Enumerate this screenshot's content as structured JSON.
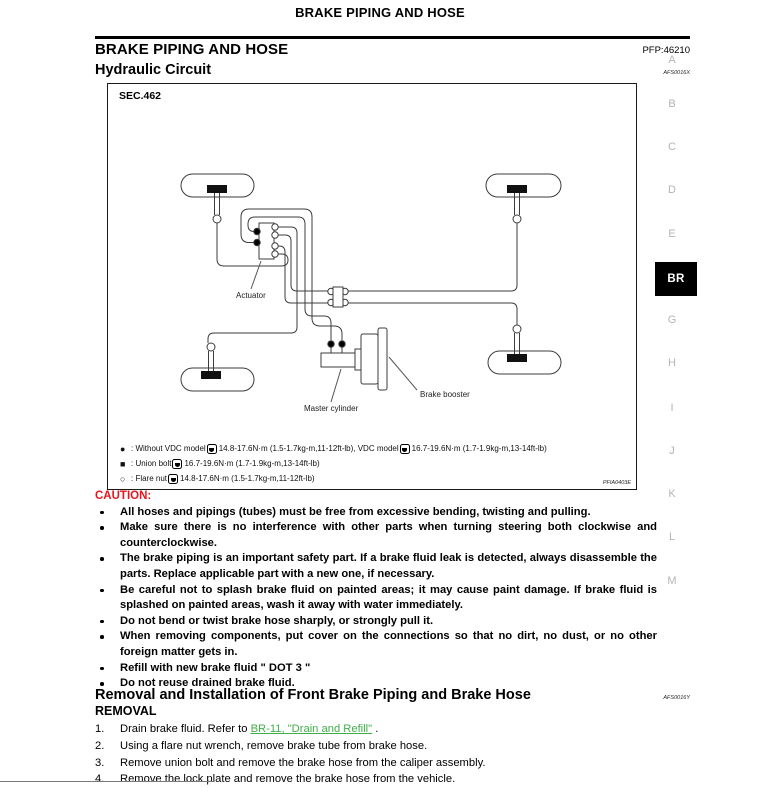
{
  "colors": {
    "caution_red": "#e8151d",
    "link_green": "#3fae49",
    "tab_gray": "#b4b4b4",
    "tab_active_bg": "#000000"
  },
  "header": {
    "page_title": "BRAKE PIPING AND HOSE"
  },
  "section": {
    "title": "BRAKE PIPING AND HOSE",
    "pfp": "PFP:46210"
  },
  "hydraulic": {
    "title": "Hydraulic Circuit",
    "ref": "AFS0016X"
  },
  "figure": {
    "sec": "SEC.462",
    "id": "PFIA0403E",
    "labels": {
      "actuator": "Actuator",
      "master_cylinder": "Master cylinder",
      "brake_booster": "Brake booster"
    },
    "legend": [
      {
        "symbol": "●",
        "parts": [
          ": Without VDC model ",
          "14.8-17.6N·m (1.5-1.7kg-m,11-12ft-lb), VDC model ",
          " 16.7-19.6N·m (1.7-1.9kg-m,13-14ft-lb)"
        ]
      },
      {
        "symbol": "■",
        "parts": [
          ": Union bolt ",
          "16.7-19.6N·m (1.7-1.9kg-m,13-14ft-lb)"
        ]
      },
      {
        "symbol": "○",
        "parts": [
          ": Flare nut ",
          "14.8-17.6N·m (1.5-1.7kg-m,11-12ft-lb)"
        ]
      }
    ]
  },
  "caution": {
    "title": "CAUTION:",
    "items": [
      "All hoses and pipings (tubes) must be free from excessive bending, twisting and pulling.",
      "Make sure there is no interference with other parts when turning steering both clockwise and counterclockwise.",
      "The brake piping is an important safety part. If a brake fluid leak is detected, always disassemble the parts. Replace applicable part with a new one, if necessary.",
      "Be careful not to splash brake fluid on painted areas; it may cause paint damage. If brake fluid is splashed on painted areas, wash it away with water immediately.",
      "Do not bend or twist brake hose sharply, or strongly pull it.",
      "When removing components, put cover on the connections so that no dirt, no dust, or no other foreign matter gets in.",
      "Refill with new brake fluid \" DOT 3 \"",
      "Do not reuse drained brake fluid."
    ]
  },
  "removal_section": {
    "title": "Removal and Installation of Front Brake Piping and Brake Hose",
    "ref": "AFS0016Y",
    "subtitle": "REMOVAL",
    "steps": [
      {
        "num": "1.",
        "prefix": "Drain brake fluid. Refer to ",
        "link": "BR-11, \"Drain and Refill\"",
        "suffix": " ."
      },
      {
        "num": "2.",
        "text": "Using a flare nut wrench, remove brake tube from brake hose."
      },
      {
        "num": "3.",
        "text": "Remove union bolt and remove the brake hose from the caliper assembly."
      },
      {
        "num": "4.",
        "text": "Remove the lock plate and remove the brake hose from the vehicle."
      }
    ]
  },
  "tabs": {
    "items": [
      "A",
      "B",
      "C",
      "D",
      "E",
      "G",
      "H",
      "I",
      "J",
      "K",
      "L",
      "M"
    ],
    "active": "BR"
  }
}
